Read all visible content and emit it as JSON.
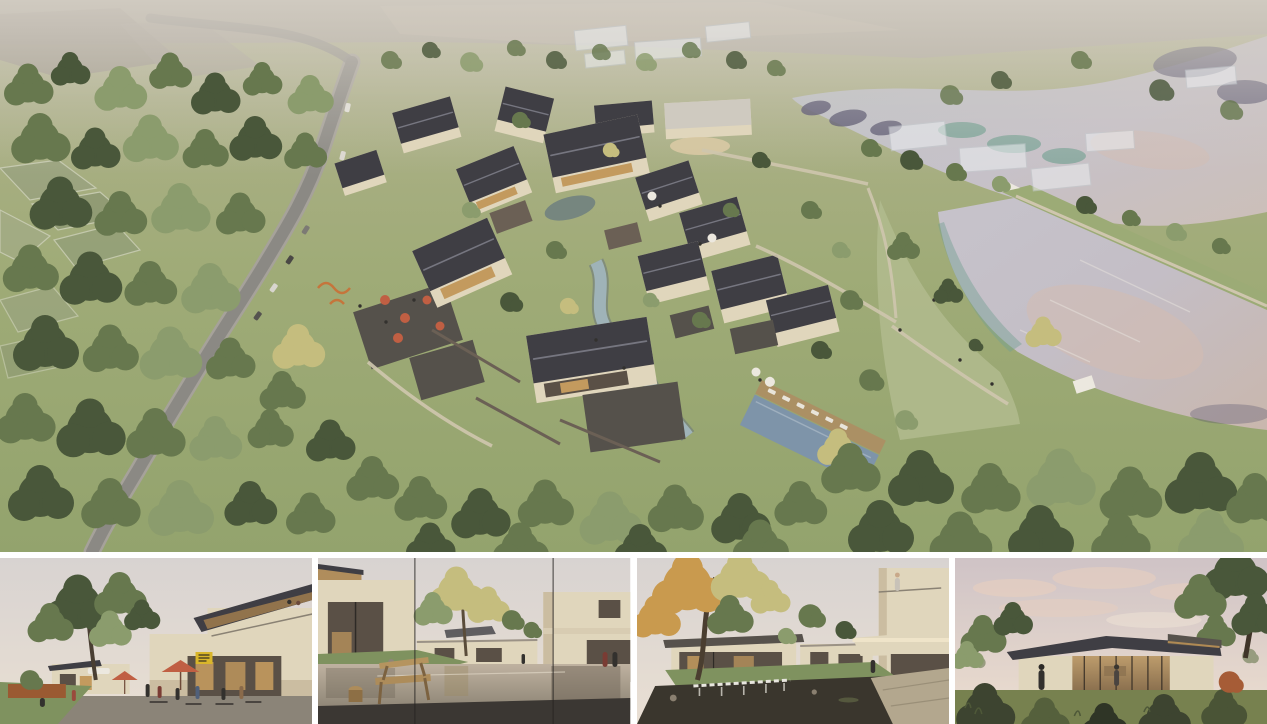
{
  "board": {
    "views": [
      {
        "id": "aerial",
        "label": "Aerial rendering of a village resort masterplan with courtyard houses, winding road, forest and two lakes"
      },
      {
        "id": "plaza",
        "label": "Street-level rendering of a plaza with cafe terrace, umbrellas and two-storey timber-roof building"
      },
      {
        "id": "pool-court",
        "label": "Rendering of a courtyard with reflecting pool and wooden bench under a yellow tree"
      },
      {
        "id": "garden-court",
        "label": "Rendering of a garden courtyard with dark pond, waterfall edge and cantilevered balcony"
      },
      {
        "id": "pavilion",
        "label": "Rendering of a single-storey glass pavilion at dusk among trees"
      }
    ]
  },
  "palette": {
    "grass-light": "#b2bb8e",
    "grass-mid": "#9cab76",
    "grass-dark": "#7f925f",
    "tree-dark": "#49573a",
    "tree-mid": "#67784e",
    "tree-light": "#8b9c6d",
    "tree-yellow": "#c5bd7e",
    "tree-autumn": "#c99a4e",
    "road": "#8b8984",
    "road-edge": "#a6a29a",
    "path": "#cfc6ae",
    "water-upper": "#c3c1ca",
    "water-lower": "#c8c0c4",
    "water-pink": "#d3bcb1",
    "water-teal": "#74a093",
    "reflect-dark": "#4b4866",
    "stream": "#9fb3b8",
    "pond-dark": "#76867f",
    "pool": "#7e94a9",
    "roof-dark": "#3f3e44",
    "roof-ridge": "#767680",
    "roof-light": "#cfcac0",
    "wall-cream": "#e0d6bc",
    "wall-shadow": "#cbbda1",
    "stone": "#6b6055",
    "paving": "#55514b",
    "deck": "#ab9064",
    "ghost": "#eceef0",
    "umbrella-red": "#c05f43",
    "umbrella-white": "#ece8df",
    "sign-yellow": "#d9b62a",
    "glass-warm": "#c39a5e",
    "glass-dark": "#5a5046",
    "bench-wood": "#ad8c5a",
    "floor-dark": "#3b3733",
    "pond3-dark": "#3a362d",
    "terrace-stone": "#b3a78e",
    "sky-pale": "#dcd8d6",
    "sky-warm": "#ece0d2",
    "cloud-pink": "#e4cdc0",
    "pavement": "#8b8478",
    "planter-rust": "#9a5a32",
    "people-dark": "#33312e"
  }
}
